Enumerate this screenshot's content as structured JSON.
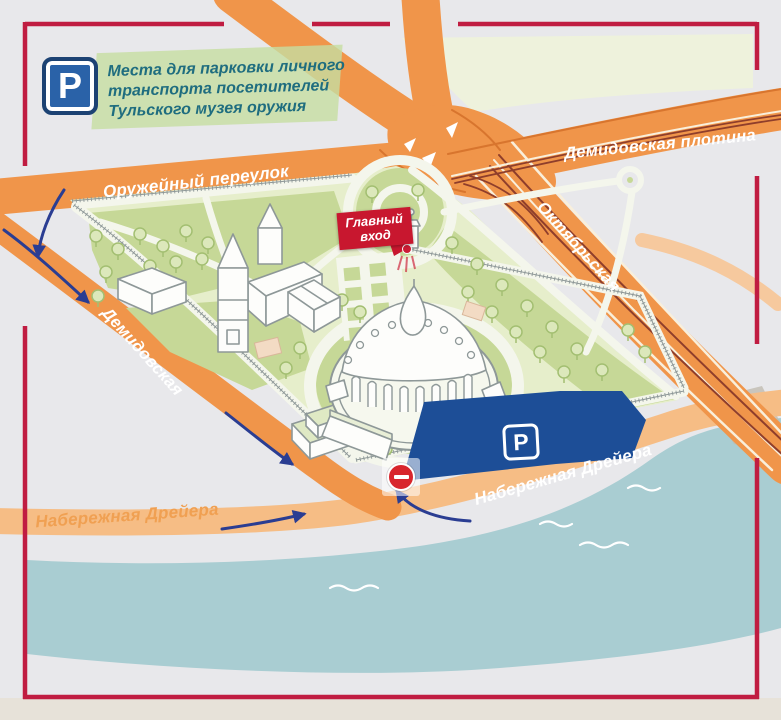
{
  "header": {
    "parking_symbol": "P",
    "line1": "Места для парковки личного",
    "line2": "транспорта посетителей",
    "line3": "Тульского музея оружия"
  },
  "streets": {
    "oruzheyny": "Оружейный переулок",
    "demidovskaya_plotina": "Демидовская плотина",
    "oktyabrskaya": "Октябрьская",
    "demidovskaya": "Демидовская",
    "naberezhnaya_dreyera_left": "Набережная Дрейера",
    "naberezhnaya_dreyera_right": "Набережная Дрейера"
  },
  "entrance": {
    "line1": "Главный",
    "line2": "вход"
  },
  "parking_area": {
    "symbol": "P"
  },
  "icons": {
    "no_entry": "no-entry-icon",
    "parking_sign": "parking-sign-icon"
  },
  "colors": {
    "frame": "#c01c41",
    "road_orange": "#f0954a",
    "road_light": "#f6bd85",
    "river": "#a9cdd2",
    "park_base": "#e6eecb",
    "lawn": "#c6d897",
    "parking_blue": "#1d4e97",
    "arrow_blue": "#2a3d92",
    "entrance_red": "#c8172f",
    "header_teal": "#1f6d7f"
  }
}
